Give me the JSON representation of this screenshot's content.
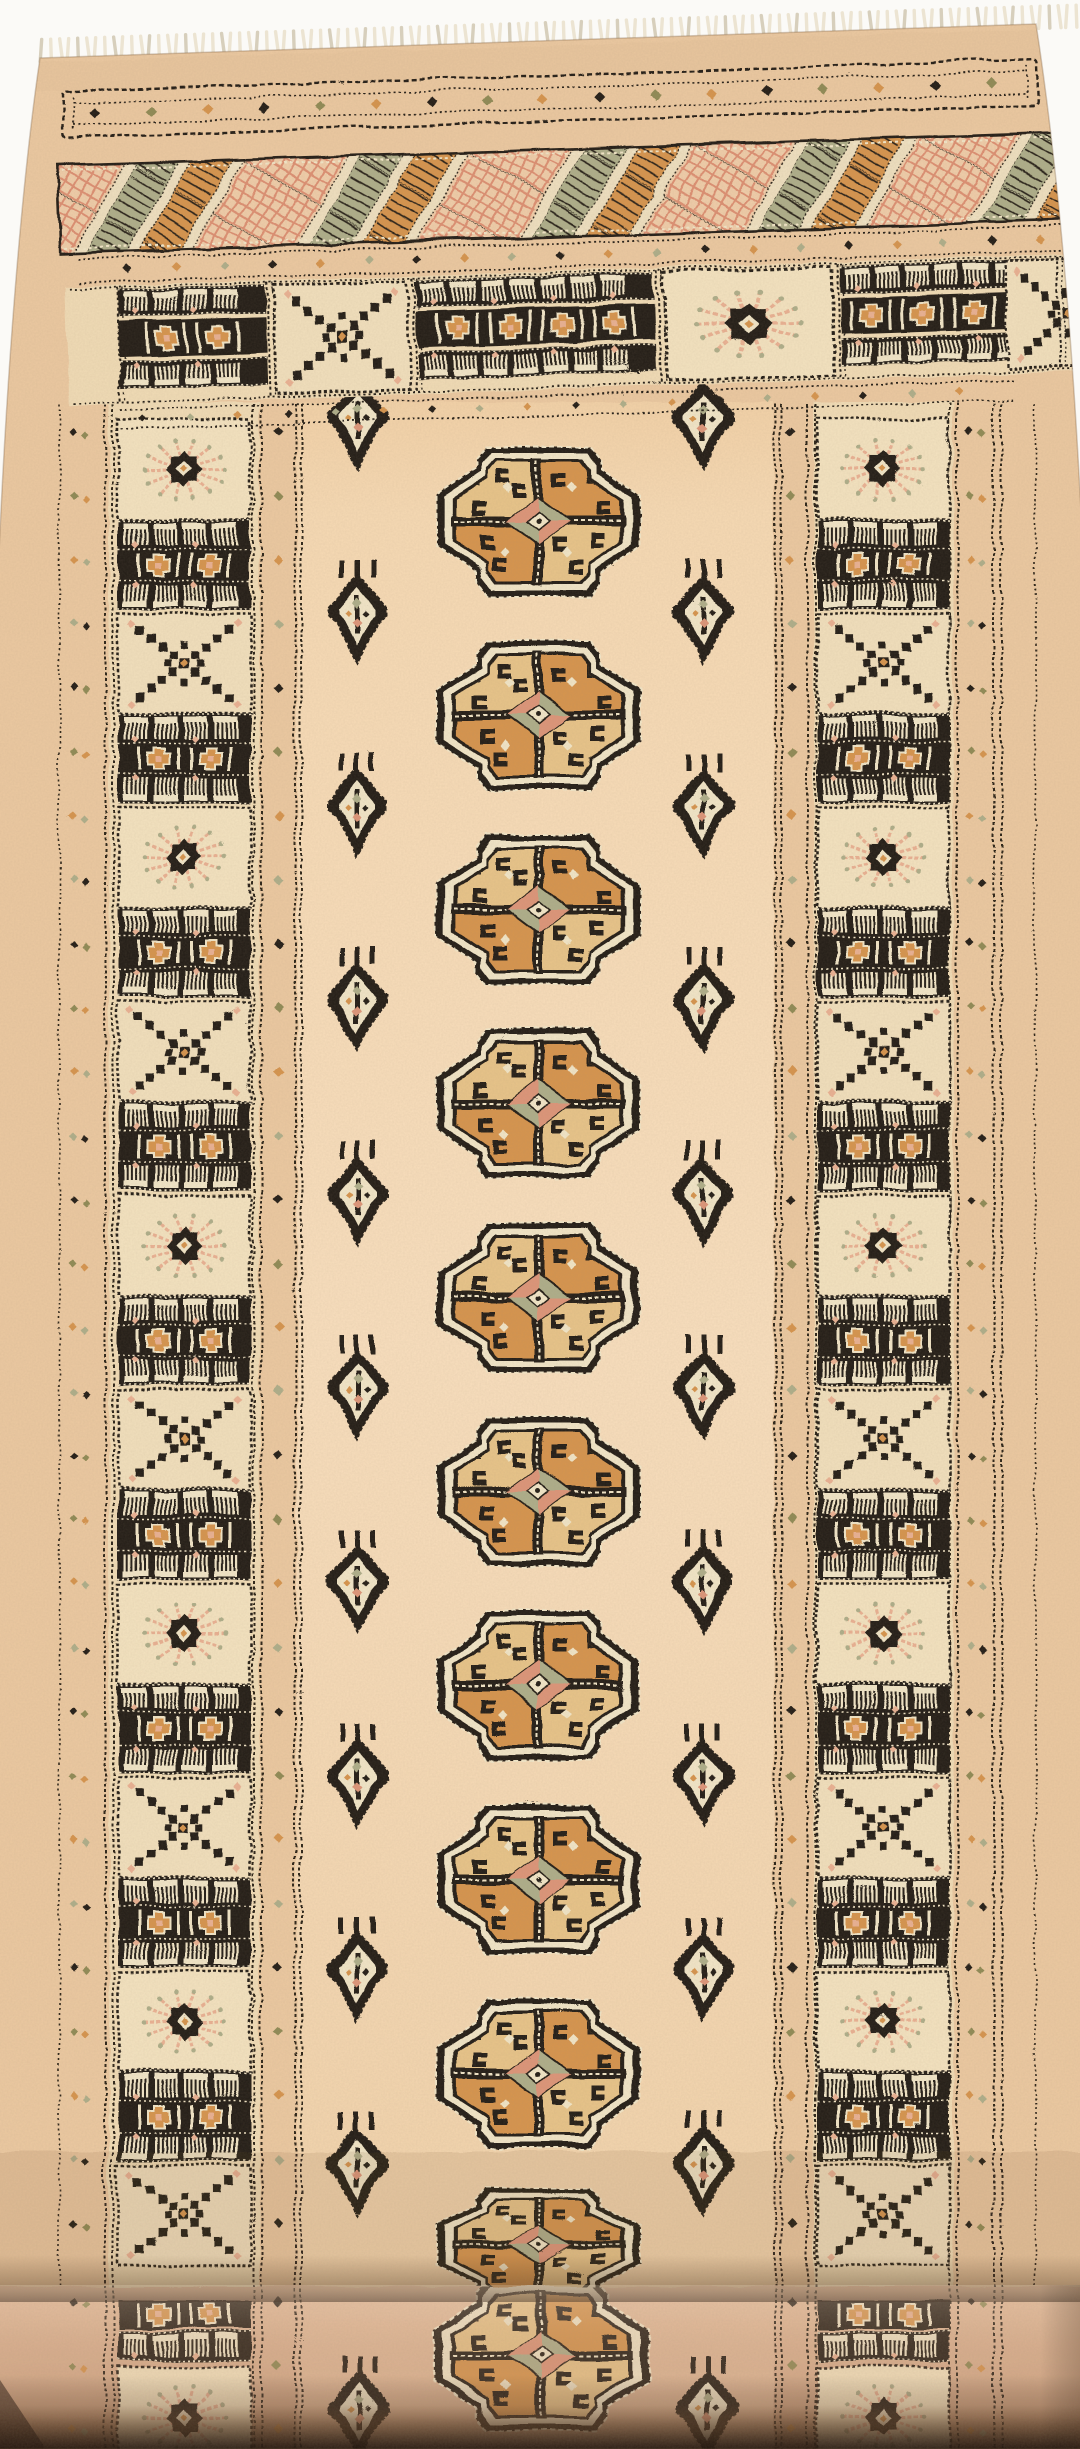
{
  "scene": {
    "description": "Photograph of a hand-knotted beige Bokhara wool runner rug on a white background, fringe at the top edge, bottom end rolled toward the camera with a dark shadow under the roll",
    "type": "photograph",
    "subject": "oriental-runner-rug"
  },
  "palette": {
    "photo_bg": "#fbfaf7",
    "fringe": "#ece4d2",
    "fringe_shadow": "#d7cfbc",
    "rug_base": "#ecc9a1",
    "field": "#f8dcb8",
    "border_bg": "#f1dcb6",
    "ink": "#221b13",
    "cream": "#f2e6c8",
    "orange": "#d6944e",
    "tan": "#e8c489",
    "salmon": "#dd9579",
    "pink": "#eab193",
    "sage": "#aeae8a",
    "olive": "#8f8a55",
    "peach": "#f0cda9",
    "roll_top": "#e2b998",
    "roll_bottom": "#a97f63",
    "shadow_dark": "#33241a"
  },
  "motifs": {
    "gul_label": "octagonal Tekke gul medallion",
    "guls_flat": 9,
    "gul_squashed_at_fold": 1,
    "guls_on_roll": 1,
    "arrowhead_rows": 10,
    "arrowhead_label": "latch-hook tree motif between medallions",
    "border_panels_per_side": 10,
    "border_panel_sequence": [
      "star-panel",
      "tree-panel"
    ],
    "top_band_sequence": [
      "corner-comb-stack",
      "tree-panel",
      "comb-cross-stack",
      "star-panel",
      "comb-cross-stack",
      "corner-comb-stack"
    ],
    "lattice_band_stripes": [
      "sage-hooked-stripe",
      "orange-hooked-stripe",
      "peach-pink-lattice-stripe"
    ],
    "fringe_tassels": 116,
    "guard_diamond_columns": 4,
    "rolled_end": true,
    "fold_shadow": true
  }
}
